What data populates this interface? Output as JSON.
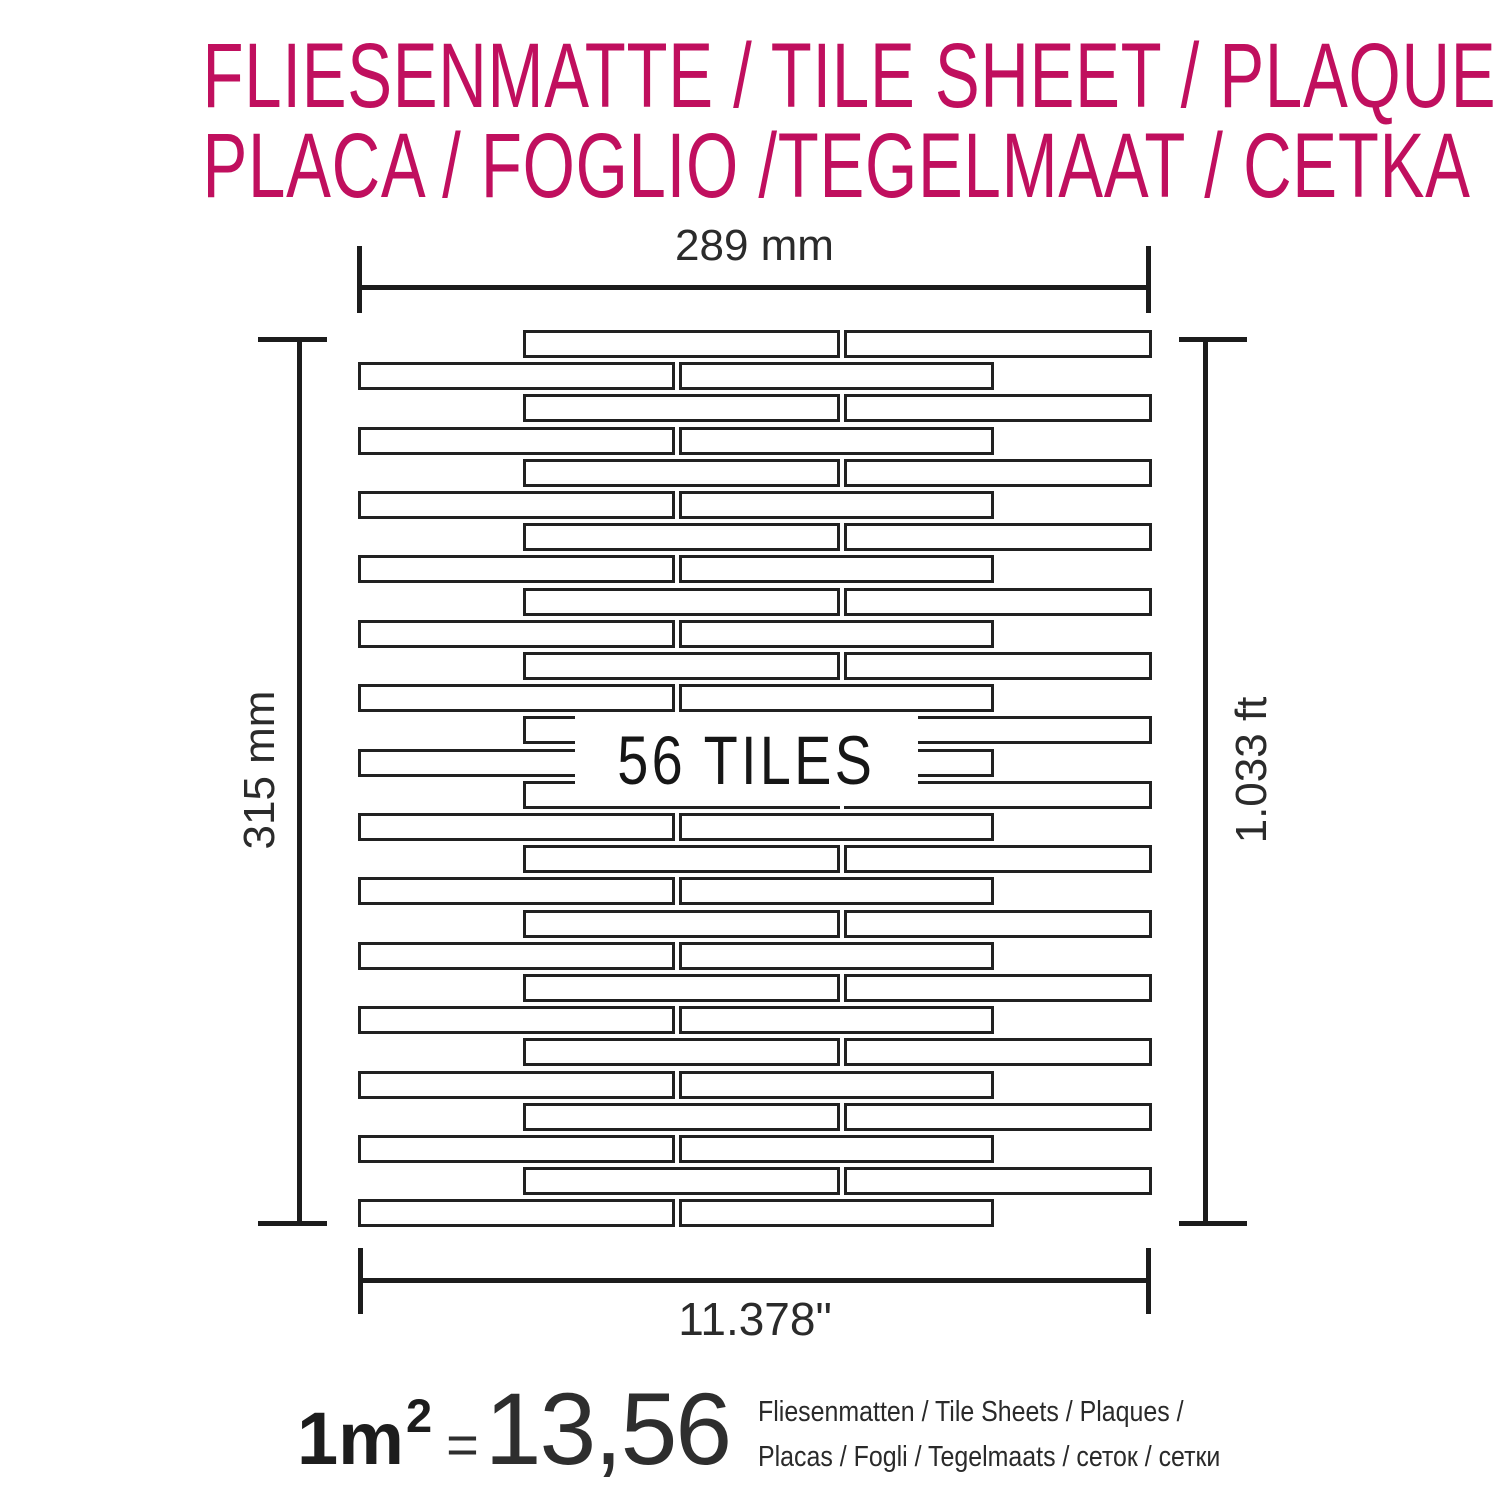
{
  "title": {
    "line1": "FLIESENMATTE / TILE SHEET / PLAQUE",
    "line2": "PLACA / FOGLIO /TEGELMAAT / CETKA",
    "color": "#c00f5e"
  },
  "diagram": {
    "tiles_label": "56 TILES",
    "dim_top": "289 mm",
    "dim_left": "315 mm",
    "dim_right": "1.033 ft",
    "dim_bottom": "11.378\"",
    "grid": {
      "row_count": 28,
      "row_top": 330,
      "row_pitch": 32.2,
      "row_height": 28,
      "rows_a": [
        [
          523,
          317
        ],
        [
          844,
          308
        ]
      ],
      "rows_b": [
        [
          358,
          317
        ],
        [
          679,
          315
        ]
      ],
      "label_box": {
        "x": 575,
        "y": 714,
        "w": 343,
        "h": 92
      }
    }
  },
  "footer": {
    "area": "1m",
    "exponent": "2",
    "equals": "=",
    "count": "13,56",
    "line1": "Fliesenmatten / Tile Sheets /  Plaques /",
    "line2": "Placas / Fogli / Tegelmaats / сеток / сетки"
  }
}
